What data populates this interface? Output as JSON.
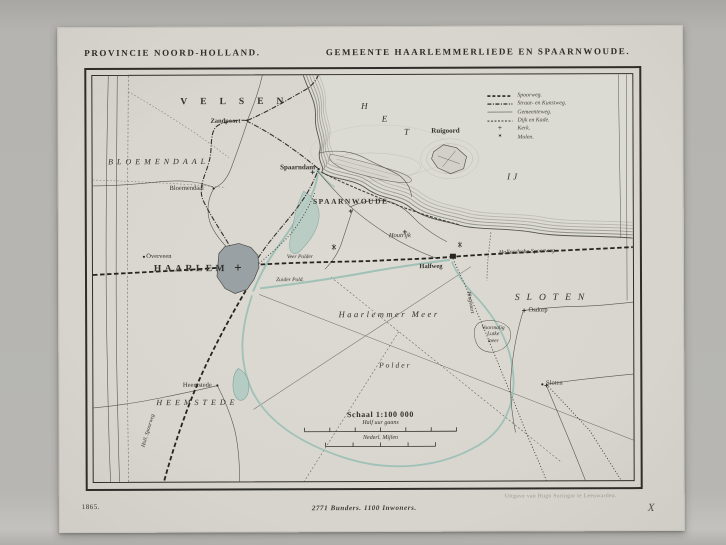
{
  "titles": {
    "left": "PROVINCIE NOORD-HOLLAND.",
    "right": "GEMEENTE HAARLEMMERLIEDE EN SPAARNWOUDE."
  },
  "footer": {
    "year": "1865.",
    "statistics": "2771 Bunders.  1100 Inwoners.",
    "publisher": "Uitgave van Hugo Suringar te Leeuwarden.",
    "mark": "X"
  },
  "legend": {
    "items": [
      {
        "label": "Spoorweg."
      },
      {
        "label": "Straat- en Kunstweg."
      },
      {
        "label": "Gemeenteweg."
      },
      {
        "label": "Dijk en Kade."
      },
      {
        "label": "Kerk.",
        "symbol": "+"
      },
      {
        "label": "Molen.",
        "symbol": "✶"
      }
    ]
  },
  "scale": {
    "title": "Schaal 1:100 000",
    "bar1_label": "Half uur gaans",
    "bar2_label": "Nederl. Mijlen"
  },
  "map": {
    "labels": [
      {
        "text": "VELSEN",
        "x": 238,
        "y": 101,
        "fs": 9.5,
        "ls": 13,
        "b": true
      },
      {
        "text": "Zandpoort",
        "x": 225,
        "y": 120,
        "fs": 6.5,
        "b": true
      },
      {
        "text": "BLOEMENDAAL",
        "x": 158,
        "y": 160,
        "fs": 8,
        "ls": 4,
        "it": true
      },
      {
        "text": "Bloemendaal",
        "x": 186,
        "y": 187,
        "fs": 6.5
      },
      {
        "text": "Spaarndam",
        "x": 297,
        "y": 166,
        "fs": 7,
        "b": true
      },
      {
        "text": "SPAARNWOUDE",
        "x": 350,
        "y": 201,
        "fs": 7.5,
        "ls": 1.5,
        "b": true
      },
      {
        "text": "Houtrijk",
        "x": 399,
        "y": 235,
        "fs": 6.5,
        "it": true
      },
      {
        "text": "Ruigoord",
        "x": 445,
        "y": 130,
        "fs": 7,
        "b": true
      },
      {
        "text": "H",
        "x": 364,
        "y": 105,
        "fs": 9,
        "it": true
      },
      {
        "text": "E",
        "x": 384,
        "y": 118,
        "fs": 9,
        "it": true
      },
      {
        "text": "T",
        "x": 406,
        "y": 131,
        "fs": 9,
        "it": true
      },
      {
        "text": "IJ",
        "x": 513,
        "y": 176,
        "fs": 9,
        "ls": 3,
        "it": true
      },
      {
        "text": "Overveen",
        "x": 158,
        "y": 255,
        "fs": 6.5
      },
      {
        "text": "HAARLEM",
        "x": 190,
        "y": 268,
        "fs": 9.5,
        "ls": 3.5,
        "b": true
      },
      {
        "text": "Veer Polder",
        "x": 299,
        "y": 256,
        "fs": 5.5,
        "it": true
      },
      {
        "text": "Zuider Pold.",
        "x": 289,
        "y": 279,
        "fs": 5.5,
        "it": true
      },
      {
        "text": "Halfweg",
        "x": 430,
        "y": 266,
        "fs": 6.5,
        "b": true
      },
      {
        "text": "Hollandsche Spoorweg",
        "x": 526,
        "y": 252,
        "fs": 6,
        "it": true,
        "rot": -2
      },
      {
        "text": "SLOTEN",
        "x": 552,
        "y": 298,
        "fs": 9.5,
        "ls": 7,
        "it": true
      },
      {
        "text": "Osdorp",
        "x": 537,
        "y": 310,
        "fs": 6.5
      },
      {
        "text": "Voormalig\nLutke\nmeer",
        "x": 492,
        "y": 334,
        "fs": 5.5,
        "it": true
      },
      {
        "text": "Haarlemmer Meer",
        "x": 388,
        "y": 314,
        "fs": 8.5,
        "ls": 2.5,
        "it": true
      },
      {
        "text": "Polder",
        "x": 394,
        "y": 365,
        "fs": 7.5,
        "ls": 2,
        "it": true
      },
      {
        "text": "HEEMSTEDE",
        "x": 196,
        "y": 401,
        "fs": 8,
        "ls": 4,
        "it": true
      },
      {
        "text": "Heemstede",
        "x": 196,
        "y": 384,
        "fs": 6.5
      },
      {
        "text": "Holl. Spoorweg",
        "x": 147,
        "y": 429,
        "fs": 5.5,
        "it": true,
        "rot": -73
      },
      {
        "text": "Ringvaart",
        "x": 469,
        "y": 302,
        "fs": 5.5,
        "it": true,
        "rot": 80
      },
      {
        "text": "Sloten",
        "x": 553,
        "y": 383,
        "fs": 6.5
      }
    ]
  },
  "colors": {
    "backdrop": "#b3b2ae",
    "paper": "#d7d5cd",
    "map_background": "#dad8d0",
    "ink": "#2e2c28",
    "water_line": "#9cc0b6",
    "water_fill": "#b4ccc4",
    "city_fill": "#99a1a5",
    "hatch": "#97978f"
  }
}
